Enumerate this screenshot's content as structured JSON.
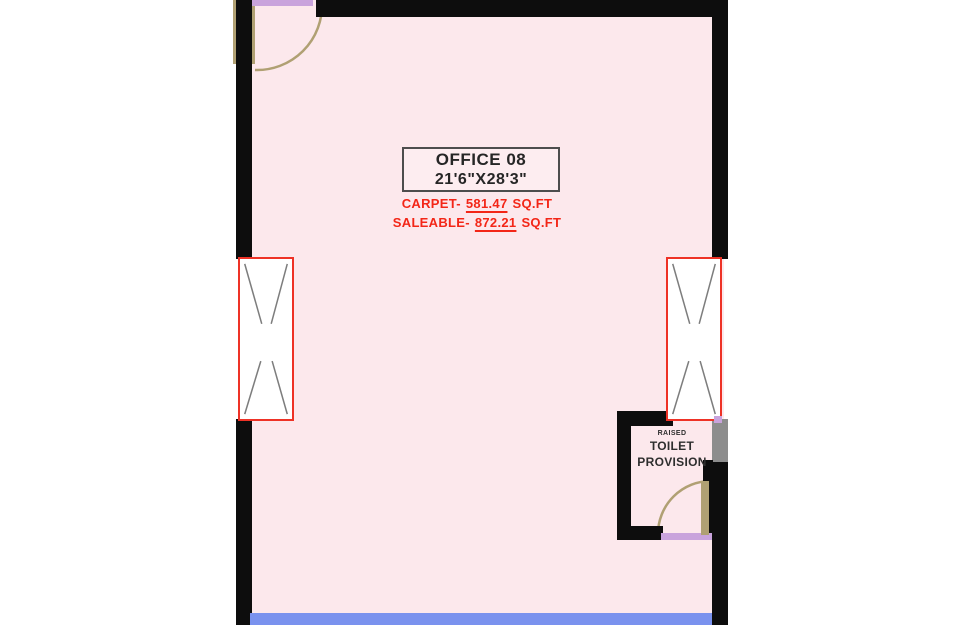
{
  "plan": {
    "room": {
      "name": "OFFICE 08",
      "dimensions": "21'6\"X28'3\"",
      "carpet_label": "CARPET-",
      "carpet_value": "581.47",
      "carpet_unit": "SQ.FT",
      "saleable_label": "SALEABLE-",
      "saleable_value": "872.21",
      "saleable_unit": "SQ.FT"
    },
    "toilet": {
      "note": "RAISED",
      "name_line1": "TOILET",
      "name_line2": "PROVISION"
    }
  },
  "colors": {
    "floor": "#fce8ec",
    "wall": "#0d0d0d",
    "window-frame": "#ee3226",
    "window-glass": "#ffffff",
    "window-lines": "#7d7d7d",
    "door": "#b0a073",
    "boundary-blue": "#7a92ee",
    "opening-lavender": "#c9a3dc",
    "wall-gray": "#8d8d8d",
    "area-text-red": "#f32617",
    "label-text": "#262626",
    "label-box-border": "#4d4d4d"
  }
}
